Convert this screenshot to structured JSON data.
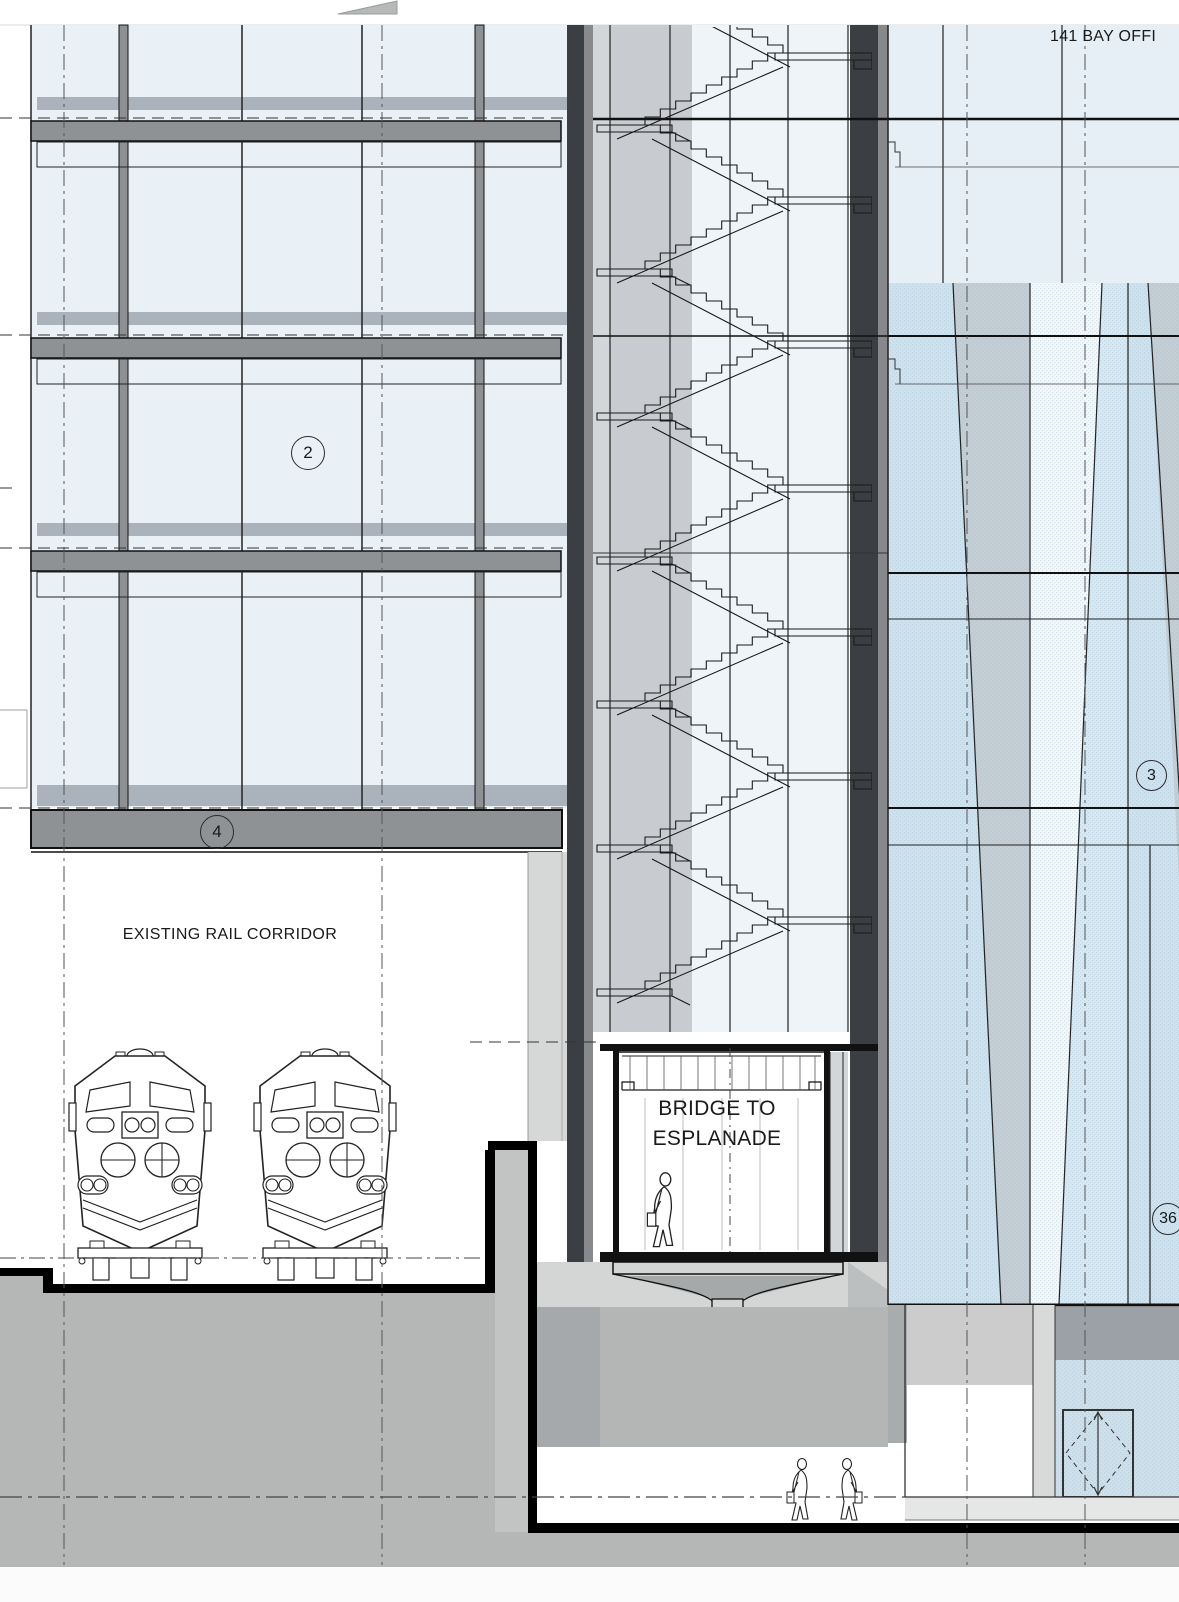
{
  "header": {
    "title": "141 BAY OFFI"
  },
  "labels": {
    "rail_corridor": "EXISTING RAIL CORRIDOR",
    "bridge_line1": "BRIDGE TO",
    "bridge_line2": "ESPLANADE"
  },
  "grid_bubbles": {
    "left_tower": "2",
    "left_base": "4",
    "right_tower": "3",
    "right_lower": "36"
  },
  "figures": {
    "train_count": 2,
    "people_count": 3
  },
  "colors": {
    "glass_left": "#e9f1f7",
    "spandrel": "#aab3bb",
    "floor_band": "#8f9295",
    "dark_wall": "#3b3f43",
    "wall_stripe": "#87898c",
    "core_gray": "#c8ccd0",
    "stair_bg": "#eef4f8",
    "tower_blue": "#cfe2ee",
    "tower_gray": "#c6cdd3",
    "tower_white": "#f3f8fb",
    "tower_light_blue": "#d8e9f3",
    "storefront_glass": "#cfe0ea",
    "concrete": "#d4d6d6",
    "concrete_dark": "#a6a9ab",
    "ground": "#b5b7b7",
    "cut_line": "#000000"
  }
}
